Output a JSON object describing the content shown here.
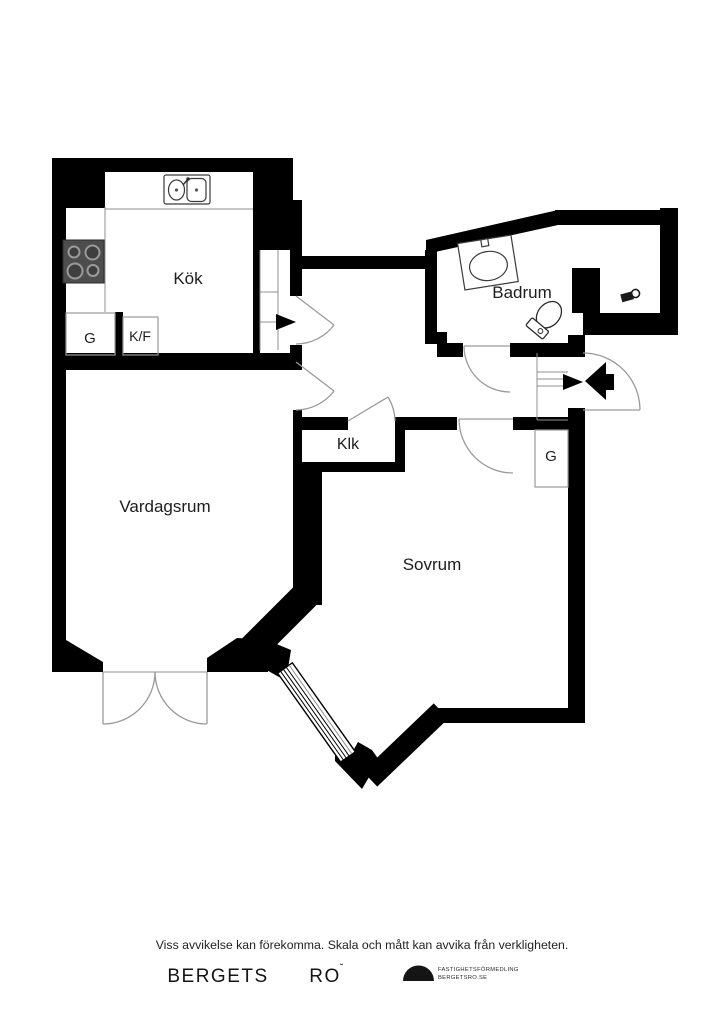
{
  "floorplan": {
    "labels": {
      "kitchen": "Kök",
      "bathroom": "Badrum",
      "closet": "Klk",
      "living_room": "Vardagsrum",
      "bedroom": "Sovrum",
      "wardrobe_kitchen": "G",
      "fridge_freezer": "K/F",
      "wardrobe_bedroom": "G"
    },
    "icons": [
      "kitchen-sink-icon",
      "stove-icon",
      "bathroom-sink-icon",
      "toilet-icon",
      "valve-icon",
      "entry-arrow-icon",
      "kitchen-entry-arrow-icon",
      "window-hatch",
      "door-swing-arc",
      "stair-treads"
    ],
    "colors": {
      "wall": "#000000",
      "stove_body": "#4d4d4d",
      "door_arc": "#9a9a9a",
      "label_text": "#1d1d1d"
    }
  },
  "footer": {
    "disclaimer": "Viss avvikelse kan förekomma. Skala och mått kan avvika från verkligheten.",
    "brand_word_1": "BERGETS",
    "brand_word_2": "RO",
    "brand_word_2_mark": "˘",
    "agency_line_1": "FASTIGHETSFÖRMEDLING",
    "agency_line_2": "BERGETSRO.SE"
  }
}
